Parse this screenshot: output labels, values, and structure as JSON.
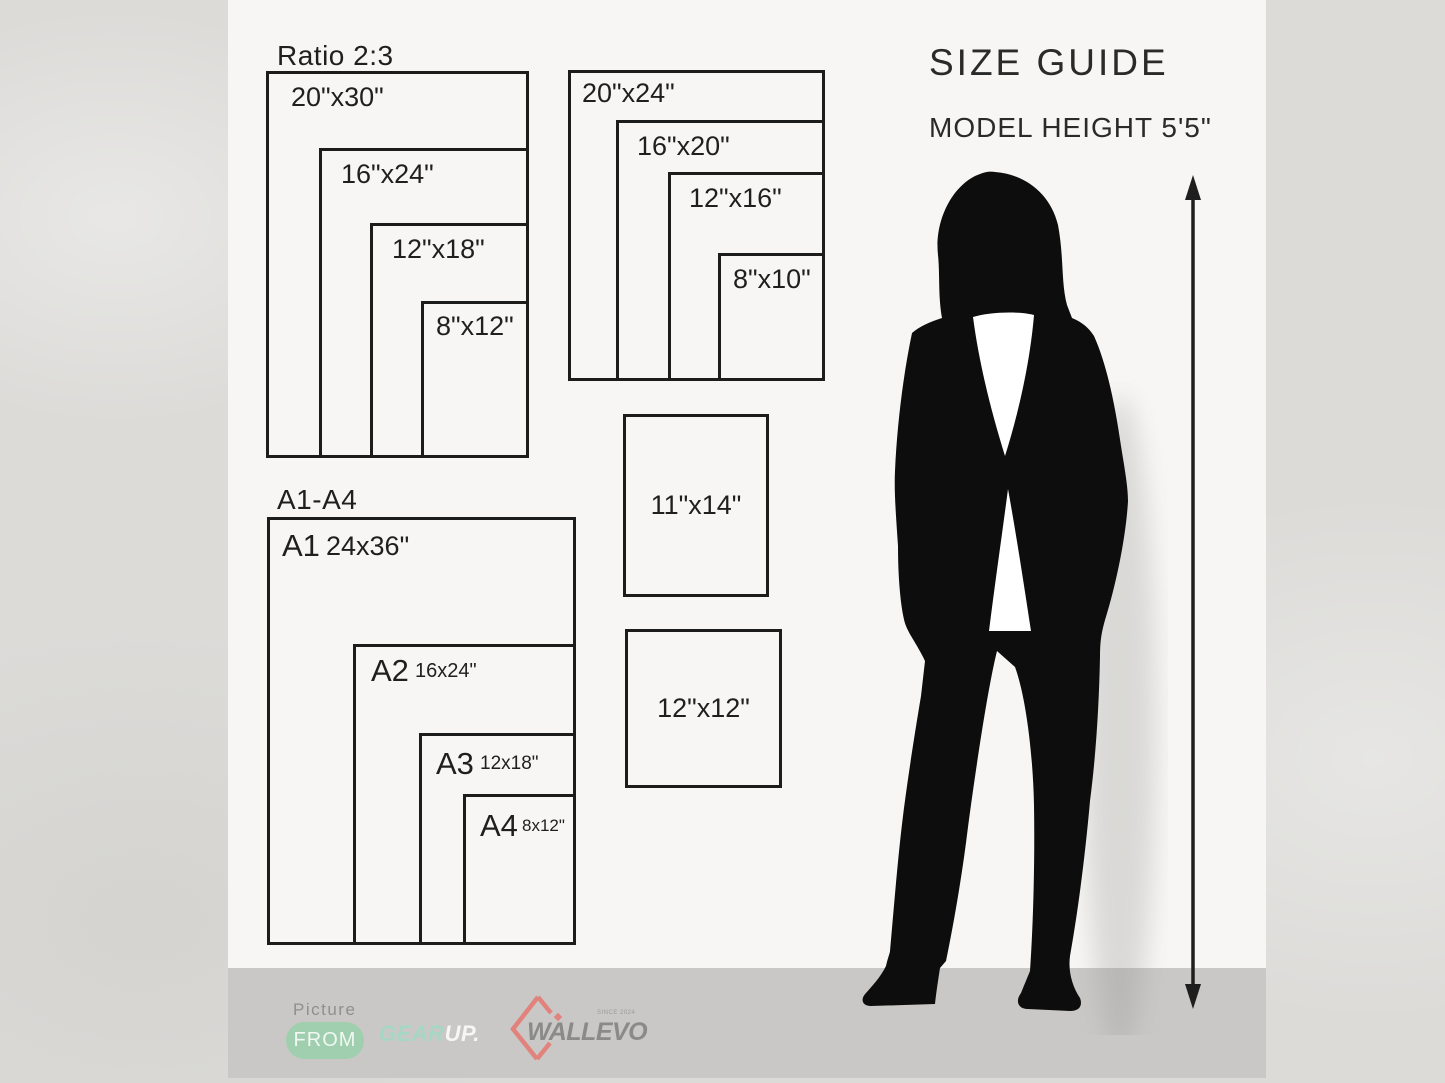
{
  "header": {
    "title": "SIZE GUIDE",
    "model_height": "MODEL HEIGHT 5'5\""
  },
  "ratio_group": {
    "heading": "Ratio 2:3",
    "sizes": [
      "20\"x30\"",
      "16\"x24\"",
      "12\"x18\"",
      "8\"x12\""
    ]
  },
  "standard_group": {
    "sizes": [
      "20\"x24\"",
      "16\"x20\"",
      "12\"x16\"",
      "8\"x10\""
    ]
  },
  "a_series_group": {
    "heading": "A1-A4",
    "items": [
      {
        "label": "A1",
        "size": "24x36\""
      },
      {
        "label": "A2",
        "size": "16x24\""
      },
      {
        "label": "A3",
        "size": "12x18\""
      },
      {
        "label": "A4",
        "size": "8x12\""
      }
    ]
  },
  "single_sizes": [
    "11\"x14\"",
    "12\"x12\""
  ],
  "footer": {
    "picture_label": "Picture",
    "from_badge": "FROM",
    "gearup_part1": "GEAR",
    "gearup_part2": "UP.",
    "wallevo_name": "WALLEVO",
    "wallevo_since": "SINCE 2024"
  },
  "colors": {
    "panel": "#f7f6f4",
    "footer_band": "#c9c8c6",
    "outline": "#1c1c1c",
    "from_badge_green": "#9fcfae",
    "gearup_mint": "#a6d7c6",
    "wallevo_red": "#e2827d",
    "wallevo_gray": "#8a8a8a"
  }
}
